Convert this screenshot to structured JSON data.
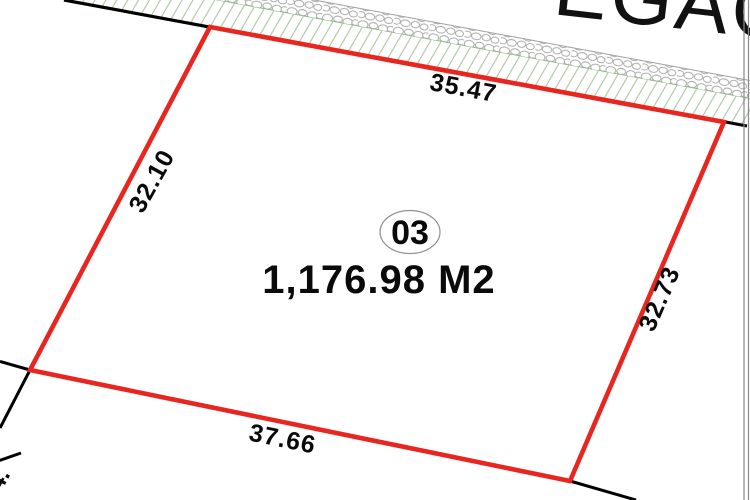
{
  "diagram": {
    "street_text_fragment": "EGAC",
    "lot": {
      "number": "03",
      "area_label": "1,176.98 M2"
    },
    "dimensions": {
      "top": "35.47",
      "left": "32.10",
      "right": "32.73",
      "bottom": "37.66"
    },
    "corner_fragment": "4.",
    "colors": {
      "parcel_boundary_red": "#e8261f",
      "survey_line_black": "#000000",
      "road_hatch_green": "#a9c69e",
      "hatch_edge_green": "#8ebc85",
      "stone_outline_gray": "#a3a3a3",
      "wall_line_gray": "#8a8a8a",
      "lot_ellipse_gray": "#909090"
    }
  }
}
